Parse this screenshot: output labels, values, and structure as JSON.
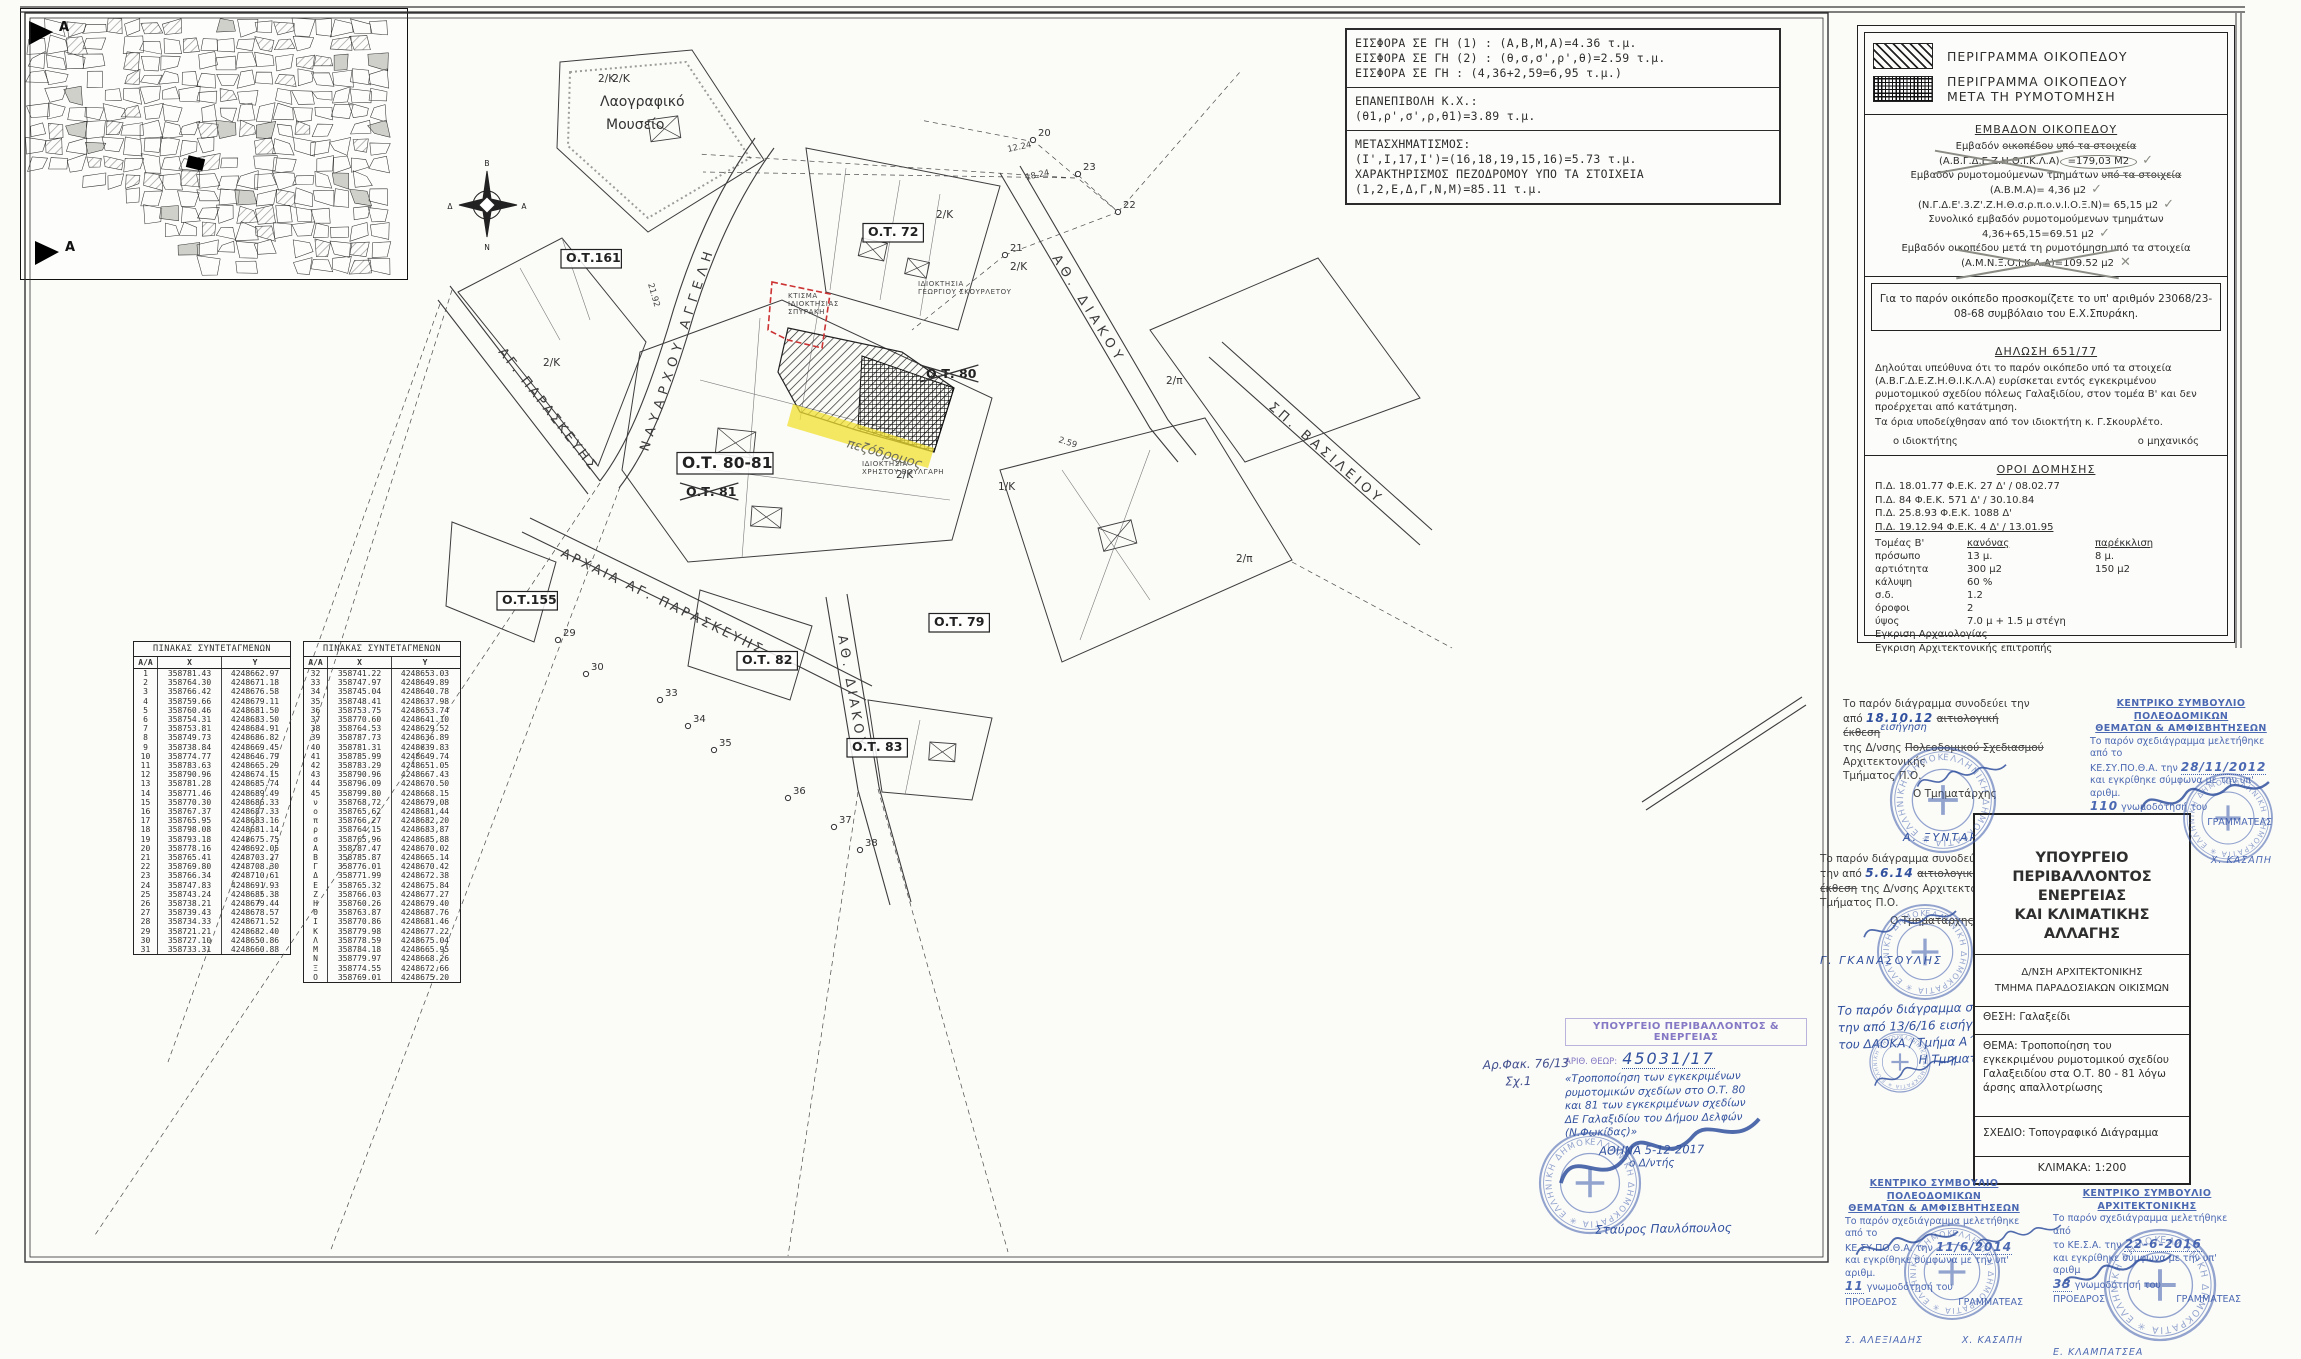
{
  "colors": {
    "ink": "#31519f",
    "stamp_blue": "#3d5cad",
    "stamp_purple": "#8578c4",
    "highlight": "#f2e030",
    "red_outline": "#cc3333"
  },
  "contribution_box": {
    "s1": [
      "ΕΙΣΦΟΡΑ ΣΕ ΓΗ (1) : (Α,Β,Μ,Α)=4.36 τ.μ.",
      "ΕΙΣΦΟΡΑ ΣΕ ΓΗ (2) : (θ,σ,σ',ρ',θ)=2.59 τ.μ.",
      "ΕΙΣΦΟΡΑ ΣΕ ΓΗ : (4,36+2,59=6,95 τ.μ.)"
    ],
    "s2": [
      "ΕΠΑΝΕΠΙΒΟΛΗ Κ.Χ.:",
      "(θ1,ρ',σ',ρ,θ1)=3.89 τ.μ."
    ],
    "s3": [
      "ΜΕΤΑΣΧΗΜΑΤΙΣΜΟΣ:",
      "(Ι',Ι,17,Ι')=(16,18,19,15,16)=5.73 τ.μ.",
      "ΧΑΡΑΚΤΗΡΙΣΜΟΣ ΠΕΖΟΔΡΟΜΟΥ ΥΠΟ ΤΑ ΣΤΟΙΧΕΙΑ",
      "(1,2,Ε,Δ,Γ,Ν,Μ)=85.11 τ.μ."
    ]
  },
  "legend": {
    "item1": "ΠΕΡΙΓΡΑΜΜΑ ΟΙΚΟΠΕΔΟΥ",
    "item2a": "ΠΕΡΙΓΡΑΜΜΑ ΟΙΚΟΠΕΔΟΥ",
    "item2b": "ΜΕΤΑ ΤΗ ΡΥΜΟΤΟΜΗΣΗ",
    "area_title": "ΕΜΒΑΔΟΝ ΟΙΚΟΠΕΔΟΥ",
    "a1_pre": "Εμβαδόν",
    "a1_scr": "οικοπέδου",
    "a1_post": "υπό τα στοιχεία",
    "a2_ids": "(Α.Β.Γ.Δ.Ε.Ζ.Η.Θ.Ι.Κ.Λ.Α)",
    "a2_val": "=179,03 Μ2",
    "a3_pre": "Εμβαδόν ρυμοτομούμενων τμημάτων",
    "a3_scr": "υπό τα στοιχεία",
    "a4": "(Α.Β.Μ.Α)= 4,36 μ2",
    "a5": "(Ν.Γ.Δ.Ε'.3.Ζ'.Ζ.Η.Θ.σ.ρ.π.ο.ν.Ι.Ο.Ξ.Ν)= 65,15 μ2",
    "a6": "Συνολικό εμβαδόν ρυμοτομούμενων τμημάτων",
    "a7": "4,36+65,15=69.51 μ2",
    "a8": "Εμβαδόν οικοπέδου μετά τη ρυμοτόμηση υπό τα στοιχεία",
    "a9": "(Α.Μ.Ν.Ξ.Ο.Ι.Κ.Λ.Α)=109.52 μ2",
    "check": "✓",
    "cross": "✕",
    "deed": "Για το παρόν οικόπεδο προσκομίζετε το υπ' αριθμόν 23068/23-08-68 συμβόλαιο του Ε.Χ.Σπυράκη.",
    "decl_title": "ΔΗΛΩΣΗ 651/77",
    "decl_p1": "Δηλούται υπεύθυνα ότι το παρόν οικόπεδο υπό τα στοιχεία (Α.Β.Γ.Δ.Ε.Ζ.Η.Θ.Ι.Κ.Λ.Α) ευρίσκεται εντός εγκεκριμένου ρυμοτομικού σχεδίου πόλεως Γαλαξιδίου, στον τομέα Β' και δεν προέρχεται από κατάτμηση.",
    "decl_p2": "Τα όρια υποδείχθησαν από τον ιδιοκτήτη κ. Γ.Σκουρλέτο.",
    "owner": "ο ιδιοκτήτης",
    "engineer": "ο μηχανικός",
    "oroi": {
      "title": "ΟΡΟΙ ΔΟΜΗΣΗΣ",
      "pd1": "Π.Δ. 18.01.77 Φ.Ε.Κ. 27 Δ' / 08.02.77",
      "pd2": "Π.Δ. 84 Φ.Ε.Κ. 571 Δ' / 30.10.84",
      "pd3": "Π.Δ. 25.8.93 Φ.Ε.Κ. 1088 Δ'",
      "pd4": "Π.Δ. 19.12.94 Φ.Ε.Κ. 4 Δ' / 13.01.95",
      "hdr": [
        "Τομέας Β'",
        "κανόνας",
        "παρέκκλιση"
      ],
      "rows": [
        [
          "πρόσωπο",
          "13 μ.",
          "8 μ."
        ],
        [
          "αρτιότητα",
          "300 μ2",
          "150 μ2"
        ],
        [
          "κάλυψη",
          "60 %",
          ""
        ],
        [
          "σ.δ.",
          "1.2",
          ""
        ],
        [
          "όροφοι",
          "2",
          ""
        ],
        [
          "ύψος",
          "7.0 μ + 1.5 μ στέγη",
          ""
        ]
      ],
      "appr1": "Εγκριση Αρχαιολογίας",
      "appr2": "Εγκριση Αρχιτεκτονικής επιτροπής"
    }
  },
  "coordinate_tables": {
    "title": "ΠΙΝΑΚΑΣ ΣΥΝΤΕΤΑΓΜΕΝΩΝ",
    "headers": [
      "Α/Α",
      "Χ",
      "Υ"
    ],
    "table1": [
      [
        "1",
        "358781.43",
        "4248662.97"
      ],
      [
        "2",
        "358764.30",
        "4248671.18"
      ],
      [
        "3",
        "358766.42",
        "4248676.58"
      ],
      [
        "4",
        "358759.66",
        "4248679.11"
      ],
      [
        "5",
        "358760.46",
        "4248681.50"
      ],
      [
        "6",
        "358754.31",
        "4248683.50"
      ],
      [
        "7",
        "358753.81",
        "4248684.91"
      ],
      [
        "8",
        "358749.73",
        "4248686.82"
      ],
      [
        "9",
        "358738.84",
        "4248669.45"
      ],
      [
        "10",
        "358774.77",
        "4248646.79"
      ],
      [
        "11",
        "358783.63",
        "4248665.29"
      ],
      [
        "12",
        "358790.96",
        "4248674.15"
      ],
      [
        "13",
        "358781.28",
        "4248685.74"
      ],
      [
        "14",
        "358771.46",
        "4248689.49"
      ],
      [
        "15",
        "358770.30",
        "4248686.33"
      ],
      [
        "16",
        "358767.37",
        "4248687.33"
      ],
      [
        "17",
        "358765.95",
        "4248683.16"
      ],
      [
        "18",
        "358798.08",
        "4248681.14"
      ],
      [
        "19",
        "358793.18",
        "4248675.75"
      ],
      [
        "20",
        "358778.16",
        "4248692.05"
      ],
      [
        "21",
        "358765.41",
        "4248703.27"
      ],
      [
        "22",
        "358769.80",
        "4248708.30"
      ],
      [
        "23",
        "358766.34",
        "4248710.61"
      ],
      [
        "24",
        "358747.83",
        "4248691.93"
      ],
      [
        "25",
        "358743.24",
        "4248685.38"
      ],
      [
        "26",
        "358738.21",
        "4248679.44"
      ],
      [
        "27",
        "358739.43",
        "4248678.57"
      ],
      [
        "28",
        "358734.33",
        "4248671.52"
      ],
      [
        "29",
        "358721.21",
        "4248682.40"
      ],
      [
        "30",
        "358727.10",
        "4248650.86"
      ],
      [
        "31",
        "358733.31",
        "4248660.88"
      ]
    ],
    "table2": [
      [
        "32",
        "358741.22",
        "4248653.03"
      ],
      [
        "33",
        "358747.97",
        "4248649.89"
      ],
      [
        "34",
        "358745.04",
        "4248640.78"
      ],
      [
        "35",
        "358748.41",
        "4248637.98"
      ],
      [
        "36",
        "358753.75",
        "4248653.74"
      ],
      [
        "37",
        "358770.60",
        "4248641.10"
      ],
      [
        "38",
        "358764.53",
        "4248629.52"
      ],
      [
        "39",
        "358787.73",
        "4248636.89"
      ],
      [
        "40",
        "358781.31",
        "4248639.83"
      ],
      [
        "41",
        "358785.99",
        "4248649.74"
      ],
      [
        "42",
        "358783.29",
        "4248651.05"
      ],
      [
        "43",
        "358790.96",
        "4248667.43"
      ],
      [
        "44",
        "358796.09",
        "4248670.50"
      ],
      [
        "45",
        "358799.80",
        "4248668.15"
      ],
      [
        "ν",
        "358768,72",
        "4248679,08"
      ],
      [
        "ο",
        "358765,62",
        "4248681,44"
      ],
      [
        "π",
        "358766,27",
        "4248682,20"
      ],
      [
        "ρ",
        "358764,15",
        "4248683,87"
      ],
      [
        "σ",
        "358765,96",
        "4248685,88"
      ],
      [
        "Α",
        "358787.47",
        "4248670.02"
      ],
      [
        "Β",
        "358785.87",
        "4248665.14"
      ],
      [
        "Γ",
        "358776.01",
        "4248670.42"
      ],
      [
        "Δ",
        "358771.99",
        "4248672.38"
      ],
      [
        "Ε",
        "358765.32",
        "4248675.84"
      ],
      [
        "Ζ",
        "358766.03",
        "4248677.27"
      ],
      [
        "Η",
        "358760.26",
        "4248679.40"
      ],
      [
        "Θ",
        "358763.87",
        "4248687.76"
      ],
      [
        "Ι",
        "358770.86",
        "4248681.46"
      ],
      [
        "Κ",
        "358779.98",
        "4248677.22"
      ],
      [
        "Λ",
        "358778.59",
        "4248675.04"
      ],
      [
        "Μ",
        "358784.18",
        "4248665.95"
      ],
      [
        "Ν",
        "358779.97",
        "4248668.26"
      ],
      [
        "Ξ",
        "358774.55",
        "4248672.66"
      ],
      [
        "Ο",
        "358769.01",
        "4248675.20"
      ]
    ]
  },
  "map": {
    "museum": [
      "2/Κ",
      "Λαογραφικό",
      "Μουσείο"
    ],
    "pezodromos": "πεζόδρομος",
    "compass": [
      "Β",
      "Α",
      "Ν",
      "Δ"
    ],
    "street_labels": [
      {
        "t": "ΑΓ. ΠΑΡΑΣΚΕΥΗΣ",
        "x": 498,
        "y": 352,
        "r": 52,
        "ls": 3
      },
      {
        "t": "ΝΑΥΑΡΧΟΥ ΑΓΓΕΛΗ",
        "x": 648,
        "y": 452,
        "r": -72,
        "ls": 6
      },
      {
        "t": "ΑΘ. ΔΙΑΚΟΥ",
        "x": 1052,
        "y": 258,
        "r": 58,
        "ls": 5
      },
      {
        "t": "ΣΠ. ΒΑΣΙΛΕΙΟΥ",
        "x": 1268,
        "y": 408,
        "r": 41,
        "ls": 4
      },
      {
        "t": "ΑΡΧΑΙΑ ΑΓ. ΠΑΡΑΣΚΕΥΗΣ",
        "x": 560,
        "y": 556,
        "r": 26,
        "ls": 3
      },
      {
        "t": "ΑΘ. ΔΙΑΚΟΥ",
        "x": 838,
        "y": 636,
        "r": 80,
        "ls": 4
      }
    ],
    "ot_labels": [
      {
        "t": "Ο.Τ.161",
        "x": 566,
        "y": 262,
        "box": true
      },
      {
        "t": "Ο.Τ. 72",
        "x": 868,
        "y": 236,
        "box": true
      },
      {
        "t": "Ο.Τ. 80",
        "x": 926,
        "y": 378,
        "crossed": true
      },
      {
        "t": "Ο.Τ. 80-81",
        "x": 682,
        "y": 468,
        "box": true,
        "big": true
      },
      {
        "t": "Ο.Τ. 81",
        "x": 686,
        "y": 496,
        "crossed": true
      },
      {
        "t": "Ο.Τ.155",
        "x": 502,
        "y": 604,
        "box": true
      },
      {
        "t": "Ο.Τ. 79",
        "x": 934,
        "y": 626,
        "box": true
      },
      {
        "t": "Ο.Τ. 82",
        "x": 742,
        "y": 664,
        "box": true
      },
      {
        "t": "Ο.Τ. 83",
        "x": 852,
        "y": 751,
        "box": true
      }
    ],
    "parcel_labels": [
      [
        "2/Κ",
        598,
        82
      ],
      [
        "2/Κ",
        543,
        366
      ],
      [
        "2/Κ",
        936,
        218
      ],
      [
        "2/Κ",
        1010,
        270
      ],
      [
        "2/Κ",
        896,
        478
      ],
      [
        "1/Κ",
        998,
        490
      ],
      [
        "2/π",
        1166,
        384
      ],
      [
        "2/π",
        1236,
        562
      ]
    ],
    "prop_labels": [
      {
        "lines": [
          "ΙΔΙΟΚΤΗΣΙΑ",
          "ΧΡΗΣΤΟΥ ΒΟΥΛΓΑΡΗ"
        ],
        "x": 862,
        "y": 466
      },
      {
        "lines": [
          "ΙΔΙΟΚΤΗΣΙΑ",
          "ΓΕΩΡΓΙΟΥ ΣΚΟΥΡΛΕΤΟΥ"
        ],
        "x": 918,
        "y": 286
      },
      {
        "lines": [
          "ΚΤΙΣΜΑ",
          "ΙΔΙΟΚΤΗΣΙΑΣ",
          "ΣΠΥΡΑΚΗ"
        ],
        "x": 788,
        "y": 298
      }
    ],
    "points": [
      [
        "23",
        1078,
        174
      ],
      [
        "22",
        1118,
        212
      ],
      [
        "21",
        1005,
        255
      ],
      [
        "20",
        1033,
        140
      ],
      [
        "29",
        558,
        640
      ],
      [
        "30",
        586,
        674
      ],
      [
        "33",
        660,
        700
      ],
      [
        "34",
        688,
        726
      ],
      [
        "35",
        714,
        750
      ],
      [
        "36",
        788,
        798
      ],
      [
        "37",
        834,
        827
      ],
      [
        "38",
        860,
        850
      ]
    ],
    "dims": [
      {
        "t": "12.24",
        "x": 1008,
        "y": 152,
        "r": -12
      },
      {
        "t": "18.24",
        "x": 1026,
        "y": 180,
        "r": -12
      },
      {
        "t": "21.92",
        "x": 648,
        "y": 284,
        "r": 74
      },
      {
        "t": "2.59",
        "x": 1058,
        "y": 442,
        "r": 18
      }
    ]
  },
  "inset": {
    "marker_label": "Α"
  },
  "title_block": {
    "ministry_l1": "ΥΠΟΥΡΓΕΙΟ",
    "ministry_l2": "ΠΕΡΙΒΑΛΛΟΝΤΟΣ",
    "ministry_l3": "ΕΝΕΡΓΕΙΑΣ",
    "ministry_l4": "ΚΑΙ ΚΛΙΜΑΤΙΚΗΣ ΑΛΛΑΓΗΣ",
    "dept1": "Δ/ΝΣΗ ΑΡΧΙΤΕΚΤΟΝΙΚΗΣ",
    "dept2": "ΤΜΗΜΑ ΠΑΡΑΔΟΣΙΑΚΩΝ ΟΙΚΙΣΜΩΝ",
    "thesi_label": "ΘΕΣΗ:",
    "thesi": "Γαλαξείδι",
    "thema_label": "ΘΕΜΑ:",
    "thema": "Τροποποίηση του εγκεκριμένου ρυμοτομικού σχεδίου Γαλαξειδίου στα Ο.Τ. 80 - 81 λόγω άρσης απαλλοτρίωσης",
    "sxedio_label": "ΣΧΕΔΙΟ:",
    "sxedio": "Τοπογραφικό Διάγραμμα",
    "klimaka": "ΚΛΙΜΑΚΑ: 1:200"
  },
  "notes": {
    "note1": {
      "l1": "Το παρόν διάγραμμα συνοδεύει την",
      "l2a": "από",
      "date": "18.10.12",
      "struck1": "αιτιολογική έκθεση",
      "hand": "εισήγηση",
      "l3a": "της Δ/νσης",
      "struck2": "Πολεοδομικού Σχεδιασμού",
      "l3b": "Αρχιτεκτονικής",
      "l4": "Τμήματος Π.Ο.",
      "role": "Ο Τμηματάρχης",
      "name": "Α. ΞΥΝΤΑΡΗΣ"
    },
    "note2": {
      "l1": "Το παρόν διάγραμμα συνοδεύει",
      "l2a": "την από",
      "date": "5.6.14",
      "hand": "εισήγηση",
      "struck1": "αιτιολογική",
      "struck2": "έκθεση",
      "l3": "της Δ/νσης Αρχιτεκτονικής",
      "l4": "Τμήματος Π.Ο.",
      "role_pre": "Ο",
      "role_struck": "Τμηματάρχης",
      "role_hand": "Δ/ντής",
      "name": "Γ. ΓΚΑΝΑΣΟΥΛΗΣ"
    },
    "note3": {
      "l1": "Το παρόν διάγραμμα συνοδεύει",
      "l2": "την από 13/6/16 εισήγηση",
      "l3": "του ΔΑΟΚΑ / Τμήμα Α΄",
      "role": "Η Τμηματάρχης"
    }
  },
  "stamps": {
    "round_text": "ΕΛΛΗΝΙΚΗ ΔΗΜΟΚΡΑΤΙΑ ✳ ΕΛΛΗΝΙΚΗ ΔΗΜΟΚΡΑΤΙΑ ✳",
    "kesypotha_2012": {
      "h1": "ΚΕΝΤΡΙΚΟ ΣΥΜΒΟΥΛΙΟ ΠΟΛΕΟΔΟΜΙΚΩΝ",
      "h2": "ΘΕΜΑΤΩΝ & ΑΜΦΙΣΒΗΤΗΣΕΩΝ",
      "b1": "Το παρόν σχεδιάγραμμα μελετήθηκε από το",
      "b2": "ΚΕ.ΣΥ.ΠΟ.Θ.Α. την",
      "date": "28/11/2012",
      "b3": "και εγκρίθηκε σύμφωνα με την υπ' αριθμ.",
      "num": "110",
      "b4": "γνωμοδότησή του",
      "role1": "ΠΡΟΕΔΡΟΣ",
      "role2": "ΓΡΑΜΜΑΤΕΑΣ",
      "name1": "Σ. ΑΛΕΞΙΑΔΗΣ",
      "name2": "Χ. ΚΑΣΑΠΗ"
    },
    "kesypotha_2014": {
      "h1": "ΚΕΝΤΡΙΚΟ ΣΥΜΒΟΥΛΙΟ ΠΟΛΕΟΔΟΜΙΚΩΝ",
      "h2": "ΘΕΜΑΤΩΝ & ΑΜΦΙΣΒΗΤΗΣΕΩΝ",
      "b1": "Το παρόν σχεδιάγραμμα μελετήθηκε από το",
      "b2": "ΚΕ.ΣΥ.ΠΟ.Θ.Α. την",
      "date": "11/6/2014",
      "b3": "και εγκρίθηκε σύμφωνα με την υπ' αριθμ.",
      "num": "11",
      "b4": "γνωμοδότησή του",
      "role1": "ΠΡΟΕΔΡΟΣ",
      "role2": "ΓΡΑΜΜΑΤΕΑΣ",
      "name1": "Σ. ΑΛΕΞΙΑΔΗΣ",
      "name2": "Χ. ΚΑΣΑΠΗ"
    },
    "kesa_2016": {
      "h1": "ΚΕΝΤΡΙΚΟ ΣΥΜΒΟΥΛΙΟ ΑΡΧΙΤΕΚΤΟΝΙΚΗΣ",
      "b1": "Το παρόν σχεδιάγραμμα μελετήθηκε από",
      "b2": "το ΚΕ.Σ.Α. την",
      "date": "22-6-2016",
      "b3": "και εγκρίθηκε σύμφωνα με την υπ' αριθμ",
      "num": "33",
      "b4": "γνωμοδότησή του",
      "role1": "ΠΡΟΕΔΡΟΣ",
      "role2": "ΓΡΑΜΜΑΤΕΑΣ",
      "name1": "Ε. ΚΛΑΜΠΑΤΣΕΑ"
    },
    "ministry": {
      "header": "ΥΠΟΥΡΓΕΙΟ ΠΕΡΙΒΑΛΛΟΝΤΟΣ & ΕΝΕΡΓΕΙΑΣ",
      "arith_label": "ΑΡΙΘ. ΘΕΩΡ:",
      "arith": "45031/17",
      "hl": [
        "«Τροποποίηση των εγκεκριμένων",
        "ρυμοτομικών σχεδίων στο Ο.Τ. 80",
        "και 81 των εγκεκριμένων σχεδίων",
        "ΔΕ Γαλαξιδίου του Δήμου Δελφών",
        "(Ν.Φωκίδας)»"
      ],
      "city_date": "ΑΘΗΝΑ 5-12-2017",
      "role": "ο Δ/ντής",
      "name": "Σταύρος Παυλόπουλος"
    },
    "file_note": {
      "l1": "Αρ.Φακ. 76/13",
      "l2": "Σχ.1"
    }
  }
}
